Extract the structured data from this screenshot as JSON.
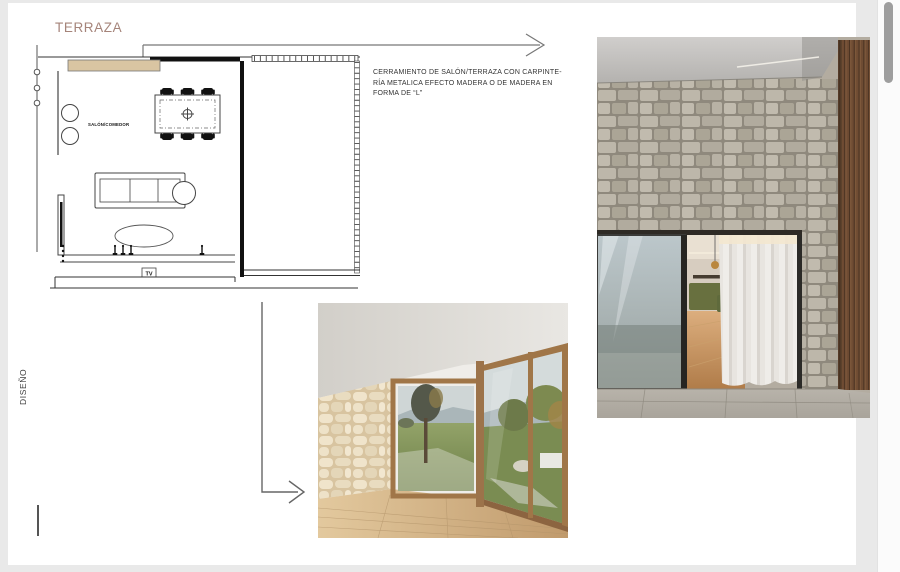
{
  "page": {
    "title": "TERRAZA",
    "vertical_label": "DISEÑO"
  },
  "plan": {
    "room_label": "SALÓN/COMEDOR",
    "tv_label": "TV"
  },
  "annotation": {
    "line1": "CERRAMIENTO DE SALÓN/TERRAZA CON CARPINTE-",
    "line2": "RÍA METALICA EFECTO MADERA O DE MADERA EN",
    "line3": "FORMA DE “L”"
  },
  "icons": {
    "top_arrow": "right-arrow-icon",
    "down_arrow": "elbow-right-arrow-icon"
  },
  "colors": {
    "title_accent": "#a5847a",
    "canvas_bg": "#e9e9e9",
    "page_bg": "#ffffff",
    "counter_fill": "#d9c5a2",
    "scrollbar_thumb": "#9e9e9e"
  }
}
